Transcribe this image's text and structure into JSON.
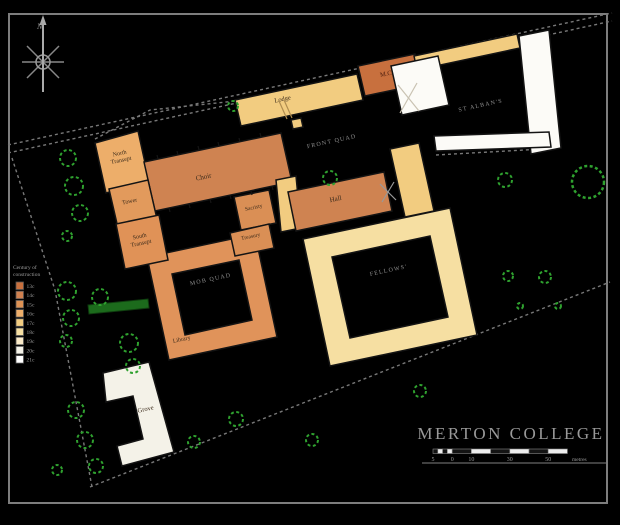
{
  "title_block": {
    "title": "MERTON COLLEGE",
    "title_x": 511,
    "title_y": 439,
    "underline": {
      "x1": 422,
      "y1": 463,
      "x2": 608,
      "y2": 463
    }
  },
  "scale_bar": {
    "y": 449,
    "h": 4.5,
    "segments": [
      {
        "x": 433.0,
        "w": 4.8,
        "f": "#141414"
      },
      {
        "x": 437.8,
        "w": 4.8,
        "f": "#EDEDED"
      },
      {
        "x": 442.6,
        "w": 4.8,
        "f": "#141414"
      },
      {
        "x": 447.4,
        "w": 4.8,
        "f": "#EDEDED"
      },
      {
        "x": 452.2,
        "w": 19.2,
        "f": "#141414"
      },
      {
        "x": 471.4,
        "w": 19.2,
        "f": "#EDEDED"
      },
      {
        "x": 490.6,
        "w": 19.2,
        "f": "#141414"
      },
      {
        "x": 509.8,
        "w": 19.2,
        "f": "#EDEDED"
      },
      {
        "x": 529.0,
        "w": 19.2,
        "f": "#141414"
      },
      {
        "x": 548.2,
        "w": 19.2,
        "f": "#EDEDED"
      }
    ],
    "labels": [
      {
        "text": "5",
        "x": 433.0
      },
      {
        "text": "0",
        "x": 452.2
      },
      {
        "text": "10",
        "x": 471.4
      },
      {
        "text": "30",
        "x": 509.8
      },
      {
        "text": "50",
        "x": 548.2
      }
    ],
    "unit": "metres",
    "unit_x": 572,
    "label_y": 461
  },
  "compass": {
    "label": "N",
    "cx": 43,
    "cy": 62
  },
  "legend": {
    "x": 13,
    "title_y": 269,
    "line_h": 7,
    "title_lines": [
      "Century of",
      "construction"
    ],
    "sw_x": 16,
    "sw_y0": 282,
    "sw_step": 9.2,
    "sw_size": 7.5,
    "items": [
      {
        "label": "13c",
        "color": "#C8703E"
      },
      {
        "label": "14c",
        "color": "#D08150"
      },
      {
        "label": "15c",
        "color": "#DE9254"
      },
      {
        "label": "16c",
        "color": "#EDAE6A"
      },
      {
        "label": "17c",
        "color": "#F2CC80"
      },
      {
        "label": "18c",
        "color": "#F6DFA2"
      },
      {
        "label": "19c",
        "color": "#FAEAC8"
      },
      {
        "label": "20c",
        "color": "#F4F2E8"
      },
      {
        "label": "21c",
        "color": "#FFFFFF"
      }
    ]
  },
  "map": {
    "frame": {
      "x": 9,
      "y": 14,
      "w": 598,
      "h": 489,
      "stroke": "#7d7d7d"
    },
    "ink": "#141414",
    "label_color": "#3b2b1b",
    "quad_label_color": "#8f8f8f",
    "wall_color": "#787878",
    "tree_color": "#2FA12F",
    "hedge_color": "#1C6B1C",
    "rotation": -12,
    "walls": [
      {
        "name": "street-upper-edge",
        "points": "8,145 612,13"
      },
      {
        "name": "street-lower-edge",
        "points": "8,153 612,21"
      },
      {
        "name": "chapel-yard-wall",
        "points": "95,139 150,110 236,101"
      },
      {
        "name": "west-boundary",
        "points": "12,158 55,290 92,487"
      },
      {
        "name": "south-boundary",
        "points": "90,487 610,282"
      },
      {
        "name": "stalbans-wall",
        "points": "436,155 560,148"
      }
    ],
    "buildings": [
      {
        "name": "fellows-quad",
        "color": "#F6DFA2",
        "points": "303,239 450,208 477,335 330,366",
        "inner": "332,257 430,236 448,317 350,338"
      },
      {
        "name": "mob-quad",
        "color": "#E0935A",
        "points": "147,257 255,234 277,337 169,360",
        "inner": "172,274 239,260 252,320 185,335",
        "label": {
          "text": "Library",
          "x": 182,
          "y": 341,
          "size": 6
        }
      },
      {
        "name": "lodge",
        "color": "#F2CC80",
        "points": "235,100 357,74 363,100 241,126",
        "label": {
          "text": "Lodge",
          "x": 283,
          "y": 101,
          "size": 6.5
        }
      },
      {
        "name": "gate-notch",
        "color": "#F2CC80",
        "points": "291,120 301,118 303,127 293,129"
      },
      {
        "name": "mcr",
        "color": "#C8703E",
        "points": "358,66 415,54 422,84 365,96",
        "label": {
          "text": "M.C.R.",
          "x": 390,
          "y": 75,
          "size": 6.5,
          "color": "#4b1d0e"
        }
      },
      {
        "name": "stalbans-street-range",
        "color": "#F2CC80",
        "points": "414,56 517,34 520,48 417,70"
      },
      {
        "name": "stalbans-west-range",
        "color": "#FCFBF7",
        "points": "391,66 438,56 449,105 402,115"
      },
      {
        "name": "stalbans-east-range",
        "color": "#FCFBF7",
        "points": "519,36 549,30 561,148 531,154"
      },
      {
        "name": "stalbans-south-range",
        "color": "#FCFBF7",
        "points": "434,136 549,132 551,147 436,151"
      },
      {
        "name": "north-transept",
        "color": "#EDAE6A",
        "points": "95,143 138,131 149,181 106,193",
        "label": {
          "lines": [
            "North",
            "Transept"
          ],
          "x": 120,
          "y": 155,
          "size": 6
        }
      },
      {
        "name": "choir",
        "color": "#CF8351",
        "points": "144,162 281,133 292,182 155,211",
        "label": {
          "text": "Choir",
          "x": 204,
          "y": 179,
          "size": 7
        }
      },
      {
        "name": "tower",
        "color": "#E29A5C",
        "points": "109,189 148,180 157,219 118,228",
        "label": {
          "text": "Tower",
          "x": 130,
          "y": 203,
          "size": 6
        }
      },
      {
        "name": "south-transept",
        "color": "#E09257",
        "points": "116,224 159,215 168,260 125,269",
        "label": {
          "lines": [
            "South",
            "Transept"
          ],
          "x": 140,
          "y": 238,
          "size": 6
        }
      },
      {
        "name": "sacristy",
        "color": "#DA8F55",
        "points": "234,197 269,190 276,223 241,230",
        "label": {
          "text": "Sacristy",
          "x": 254,
          "y": 209,
          "size": 5.5
        }
      },
      {
        "name": "treasury",
        "color": "#DA8F55",
        "points": "230,233 269,224 274,248 235,256",
        "label": {
          "text": "Treasury",
          "x": 251,
          "y": 238,
          "size": 5.5
        }
      },
      {
        "name": "front-connector",
        "color": "#F2CC80",
        "points": "276,180 296,176 301,228 281,232"
      },
      {
        "name": "hall",
        "color": "#CF8351",
        "points": "288,192 384,172 392,211 296,231",
        "label": {
          "text": "Hall",
          "x": 336,
          "y": 201,
          "size": 7
        }
      },
      {
        "name": "east-connector",
        "color": "#F2CC80",
        "points": "390,149 419,143 434,211 405,217"
      },
      {
        "name": "grove-building",
        "color": "#F4F2E8",
        "points": "103,373 149,362 174,452 122,466 117,446 143,439 133,396 106,402",
        "label": {
          "text": "Grove",
          "x": 146,
          "y": 411,
          "size": 6.5
        }
      }
    ],
    "quad_labels": [
      {
        "text": "FRONT QUAD",
        "x": 332,
        "y": 143
      },
      {
        "text": "ST ALBAN'S",
        "x": 481,
        "y": 107
      },
      {
        "text": "MOB QUAD",
        "x": 211,
        "y": 281
      },
      {
        "text": "FELLOWS'",
        "x": 389,
        "y": 272
      }
    ],
    "hedge": "88,305 148,299 149,308 89,314",
    "trees": [
      {
        "x": 68,
        "y": 158,
        "r": 8
      },
      {
        "x": 74,
        "y": 186,
        "r": 9
      },
      {
        "x": 80,
        "y": 213,
        "r": 8
      },
      {
        "x": 67,
        "y": 236,
        "r": 5
      },
      {
        "x": 233,
        "y": 106,
        "r": 5
      },
      {
        "x": 330,
        "y": 178,
        "r": 7
      },
      {
        "x": 67,
        "y": 291,
        "r": 9
      },
      {
        "x": 71,
        "y": 318,
        "r": 8
      },
      {
        "x": 66,
        "y": 341,
        "r": 6
      },
      {
        "x": 100,
        "y": 297,
        "r": 8
      },
      {
        "x": 129,
        "y": 343,
        "r": 9
      },
      {
        "x": 133,
        "y": 366,
        "r": 7
      },
      {
        "x": 76,
        "y": 410,
        "r": 8
      },
      {
        "x": 85,
        "y": 440,
        "r": 8
      },
      {
        "x": 96,
        "y": 466,
        "r": 7
      },
      {
        "x": 57,
        "y": 470,
        "r": 5
      },
      {
        "x": 194,
        "y": 442,
        "r": 6
      },
      {
        "x": 236,
        "y": 419,
        "r": 7
      },
      {
        "x": 312,
        "y": 440,
        "r": 6
      },
      {
        "x": 420,
        "y": 391,
        "r": 6
      },
      {
        "x": 505,
        "y": 180,
        "r": 7
      },
      {
        "x": 588,
        "y": 182,
        "r": 16
      },
      {
        "x": 545,
        "y": 277,
        "r": 6
      },
      {
        "x": 508,
        "y": 276,
        "r": 5
      },
      {
        "x": 520,
        "y": 306,
        "r": 3
      },
      {
        "x": 558,
        "y": 306,
        "r": 3
      }
    ],
    "decor_lines": [
      {
        "name": "roof-x",
        "x1": 398,
        "y1": 85,
        "x2": 419,
        "y2": 111,
        "c": "#C9C2B2"
      },
      {
        "name": "roof-x",
        "x1": 417,
        "y1": 83,
        "x2": 400,
        "y2": 113,
        "c": "#C9C2B2"
      },
      {
        "name": "roof-x",
        "x1": 380,
        "y1": 184,
        "x2": 396,
        "y2": 200,
        "c": "#999999"
      },
      {
        "name": "roof-x",
        "x1": 394,
        "y1": 182,
        "x2": 382,
        "y2": 202,
        "c": "#999999"
      },
      {
        "name": "lodge-door",
        "x1": 279,
        "y1": 101,
        "x2": 287,
        "y2": 119,
        "c": "#B08D4F"
      },
      {
        "name": "lodge-door",
        "x1": 284,
        "y1": 100,
        "x2": 292,
        "y2": 118,
        "c": "#B08D4F"
      },
      {
        "name": "buttress",
        "x1": 158,
        "y1": 159,
        "x2": 157,
        "y2": 155,
        "c": "#141414"
      },
      {
        "name": "buttress",
        "x1": 178,
        "y1": 155,
        "x2": 177,
        "y2": 151,
        "c": "#141414"
      },
      {
        "name": "buttress",
        "x1": 199,
        "y1": 150,
        "x2": 198,
        "y2": 146,
        "c": "#141414"
      },
      {
        "name": "buttress",
        "x1": 219,
        "y1": 146,
        "x2": 218,
        "y2": 142,
        "c": "#141414"
      },
      {
        "name": "buttress",
        "x1": 240,
        "y1": 142,
        "x2": 239,
        "y2": 138,
        "c": "#141414"
      },
      {
        "name": "buttress",
        "x1": 261,
        "y1": 137,
        "x2": 260,
        "y2": 133,
        "c": "#141414"
      },
      {
        "name": "buttress",
        "x1": 169,
        "y1": 208,
        "x2": 170,
        "y2": 212,
        "c": "#141414"
      },
      {
        "name": "buttress",
        "x1": 189,
        "y1": 204,
        "x2": 190,
        "y2": 208,
        "c": "#141414"
      },
      {
        "name": "buttress",
        "x1": 210,
        "y1": 199,
        "x2": 211,
        "y2": 203,
        "c": "#141414"
      },
      {
        "name": "buttress",
        "x1": 230,
        "y1": 195,
        "x2": 231,
        "y2": 199,
        "c": "#141414"
      },
      {
        "name": "buttress",
        "x1": 251,
        "y1": 191,
        "x2": 252,
        "y2": 195,
        "c": "#141414"
      },
      {
        "name": "buttress",
        "x1": 272,
        "y1": 186,
        "x2": 273,
        "y2": 190,
        "c": "#141414"
      }
    ]
  }
}
